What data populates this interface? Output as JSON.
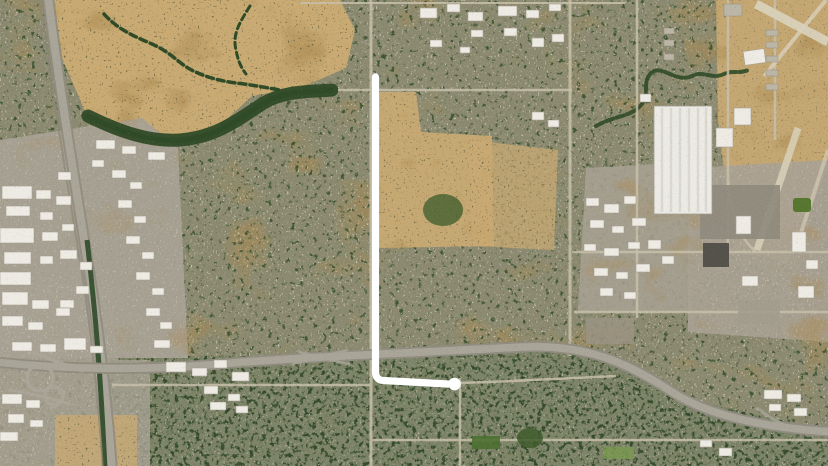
{
  "view": {
    "type": "satellite-aerial-imagery",
    "description": "Satellite view of a suburban/industrial grid: dry creek parkland at top-left, diagonal freeway corridor on the west side, east-west freeway across the bottom, large white warehouse and airport land on the right, dense residential fabric elsewhere. A white hand-drawn L-shaped line annotates a north-south road turning east at the bottom."
  },
  "annotation": {
    "name": "route-highlight-line",
    "shape": "L",
    "color": "#ffffff",
    "stroke_width": 7.2,
    "path": "M 375.5 77 L 375.5 371.5 Q 375.5 380 383.5 380.5 L 448 384",
    "endcap": {
      "cx": 454.5,
      "cy": 384,
      "r": 6.3
    }
  },
  "palette": {
    "suburb_base": "#8b8a70",
    "suburb_trees": "#39512e",
    "suburb_roofs": "#d2ccbc",
    "south_base": "#7c8367",
    "field_base": "#c9aa73",
    "field_blotch": "#a98950",
    "industrial_base": "#a8a193",
    "airport_base": "#c4a772",
    "road_minor": "#c8c0aa",
    "freeway": "#a9a598",
    "freeway_edge": "#908c80",
    "building_white": "#edebe3",
    "building_gray": "#bcb6a7",
    "building_stroke": "#a7a093",
    "creek_green": "#2f4a27",
    "median_green": "#2e4a28",
    "runway_light": "#d9d1ba",
    "dark_lot": "#54524a",
    "park_green": "#4d7030"
  },
  "features": {
    "creek_parkland": "dry creek open space, top left",
    "riparian_band": "tree corridor along south edge of open field",
    "west_corridor": "diagonal freeway/rail corridor, west side",
    "south_freeway": "east-west freeway across bottom with cloverleaf interchange at left",
    "warehouse": "large white warehouse, right-center",
    "airport": "airfield land with runways, top right",
    "industrial_parks": "white-roofed industrial buildings flanking corridors",
    "residential": "mottled gray-green suburban blocks"
  }
}
